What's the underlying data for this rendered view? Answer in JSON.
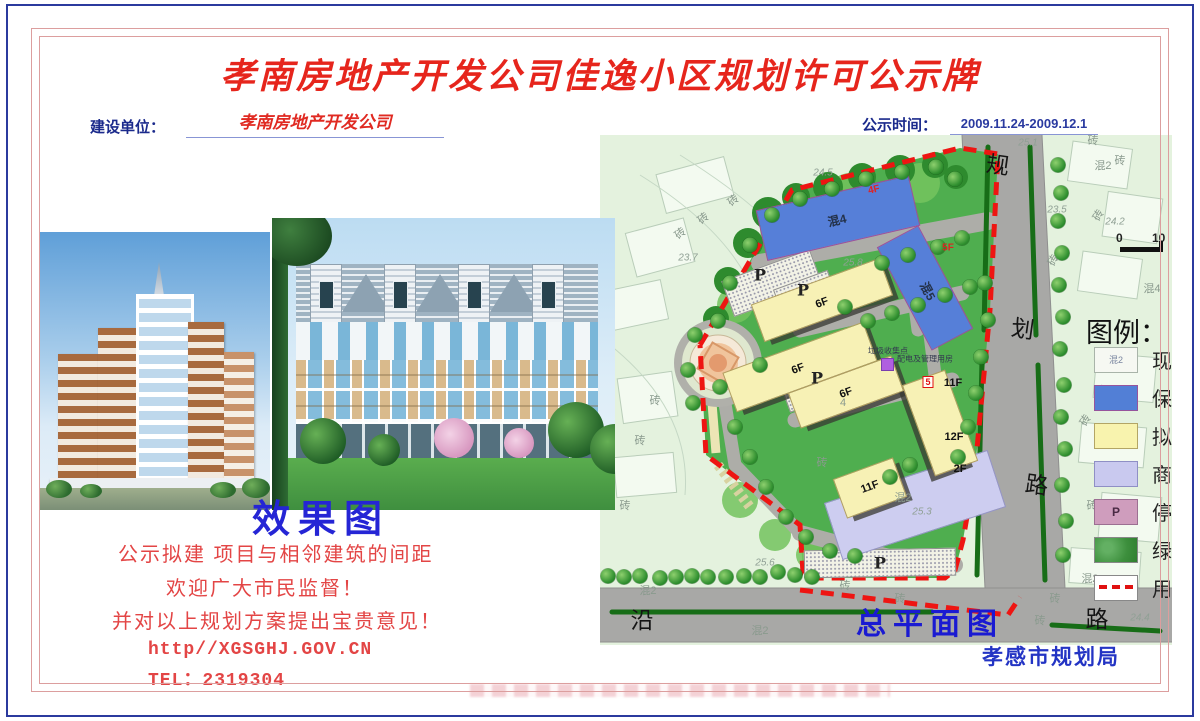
{
  "header": {
    "title": "孝南房地产开发公司佳逸小区规划许可公示牌",
    "builder_label": "建设单位：",
    "builder_value": "孝南房地产开发公司",
    "time_label": "公示时间：",
    "time_value": "2009.11.24-2009.12.1"
  },
  "left": {
    "caption": "效果图",
    "lines": [
      {
        "t": "公示拟建 项目与相邻建筑的间距",
        "x": 118,
        "y": 538,
        "mono": false
      },
      {
        "t": "欢迎广大市民监督！",
        "x": 166,
        "y": 572,
        "mono": false
      },
      {
        "t": "并对以上规划方案提出宝贵意见！",
        "x": 112,
        "y": 605,
        "mono": false
      },
      {
        "t": "http//XGSGHJ.GOV.CN",
        "x": 148,
        "y": 640,
        "mono": true
      },
      {
        "t": "TEL：2319304",
        "x": 148,
        "y": 665,
        "mono": true
      }
    ]
  },
  "map": {
    "plan_caption": "总平面图",
    "agency": "孝感市规划局",
    "legend": {
      "title": "图例：",
      "items": [
        {
          "sw": "existing",
          "sw_text": "混2",
          "label": "现"
        },
        {
          "sw": "blue",
          "sw_text": "",
          "label": "保"
        },
        {
          "sw": "yellow",
          "sw_text": "",
          "label": "拟"
        },
        {
          "sw": "lavender",
          "sw_text": "",
          "label": "商"
        },
        {
          "sw": "parking",
          "sw_text": "P",
          "label": "停"
        },
        {
          "sw": "green",
          "sw_text": "",
          "label": "绿"
        },
        {
          "sw": "redline",
          "sw_text": "",
          "label": "用"
        }
      ]
    },
    "scale": {
      "zero": "0",
      "ten": "10"
    },
    "buildings": [
      {
        "x": 315,
        "y": 370,
        "l": 170,
        "w": 58,
        "r": -18,
        "c": "#cdcdf0",
        "bc": "#9595c8",
        "sh": 0
      },
      {
        "x": 238,
        "y": 83,
        "l": 155,
        "w": 50,
        "r": -13,
        "c": "#567fd8",
        "bc": "#9c4f9c",
        "sh": 0
      },
      {
        "x": 325,
        "y": 153,
        "l": 115,
        "w": 45,
        "r": 62,
        "c": "#567fd8",
        "bc": "#9c4f9c",
        "sh": 0
      },
      {
        "x": 222,
        "y": 165,
        "l": 135,
        "w": 38,
        "r": -20,
        "c": "#f7f1b5",
        "bc": "#b3a060",
        "sh": 1
      },
      {
        "x": 200,
        "y": 232,
        "l": 148,
        "w": 40,
        "r": -20,
        "c": "#f7f1b5",
        "bc": "#b3a060",
        "sh": 1
      },
      {
        "x": 246,
        "y": 257,
        "l": 108,
        "w": 36,
        "r": -20,
        "c": "#f7f1b5",
        "bc": "#b3a060",
        "sh": 1
      },
      {
        "x": 340,
        "y": 288,
        "l": 95,
        "w": 44,
        "r": 70,
        "c": "#f7f1b5",
        "bc": "#b3a060",
        "sh": 1
      },
      {
        "x": 270,
        "y": 353,
        "l": 62,
        "w": 40,
        "r": -20,
        "c": "#f7f1b5",
        "bc": "#b3a060",
        "sh": 1
      }
    ],
    "parking": [
      {
        "x": 172,
        "y": 148,
        "l": 92,
        "w": 36,
        "r": -20
      },
      {
        "x": 205,
        "y": 158,
        "l": 56,
        "w": 26,
        "r": -20
      },
      {
        "x": 222,
        "y": 248,
        "l": 78,
        "w": 32,
        "r": -20
      },
      {
        "x": 280,
        "y": 428,
        "l": 150,
        "w": 26,
        "r": -1
      }
    ],
    "trees": [
      [
        458,
        30
      ],
      [
        461,
        58
      ],
      [
        458,
        86
      ],
      [
        462,
        118
      ],
      [
        459,
        150
      ],
      [
        463,
        182
      ],
      [
        460,
        214
      ],
      [
        464,
        250
      ],
      [
        461,
        282
      ],
      [
        465,
        314
      ],
      [
        462,
        350
      ],
      [
        466,
        386
      ],
      [
        463,
        420
      ],
      [
        8,
        441
      ],
      [
        24,
        442
      ],
      [
        40,
        441
      ],
      [
        60,
        443
      ],
      [
        76,
        442
      ],
      [
        92,
        441
      ],
      [
        108,
        442
      ],
      [
        126,
        442
      ],
      [
        144,
        441
      ],
      [
        160,
        442
      ],
      [
        178,
        437
      ],
      [
        195,
        440
      ],
      [
        212,
        442
      ],
      [
        172,
        80
      ],
      [
        200,
        64
      ],
      [
        232,
        54
      ],
      [
        266,
        44
      ],
      [
        302,
        37
      ],
      [
        336,
        32
      ],
      [
        355,
        44
      ],
      [
        150,
        110
      ],
      [
        130,
        148
      ],
      [
        118,
        186
      ],
      [
        282,
        128
      ],
      [
        308,
        120
      ],
      [
        338,
        112
      ],
      [
        362,
        103
      ],
      [
        245,
        172
      ],
      [
        268,
        186
      ],
      [
        292,
        178
      ],
      [
        318,
        170
      ],
      [
        345,
        160
      ],
      [
        370,
        152
      ],
      [
        385,
        148
      ],
      [
        388,
        185
      ],
      [
        381,
        222
      ],
      [
        376,
        258
      ],
      [
        368,
        292
      ],
      [
        358,
        322
      ],
      [
        120,
        252
      ],
      [
        135,
        292
      ],
      [
        150,
        322
      ],
      [
        166,
        352
      ],
      [
        186,
        382
      ],
      [
        206,
        402
      ],
      [
        230,
        416
      ],
      [
        255,
        421
      ],
      [
        95,
        200
      ],
      [
        88,
        235
      ],
      [
        93,
        268
      ],
      [
        160,
        230
      ],
      [
        310,
        330
      ],
      [
        290,
        342
      ]
    ],
    "labels": [
      {
        "t": "规",
        "x": 398,
        "y": 28,
        "k": "road",
        "r": 8
      },
      {
        "t": "划",
        "x": 423,
        "y": 192,
        "k": "road",
        "r": 8
      },
      {
        "t": "路",
        "x": 437,
        "y": 348,
        "k": "road",
        "r": 8
      },
      {
        "t": "沿",
        "x": 42,
        "y": 483,
        "k": "road",
        "r": 0
      },
      {
        "t": "路",
        "x": 497,
        "y": 482,
        "k": "road",
        "r": 0
      },
      {
        "t": "混4",
        "x": 237,
        "y": 85,
        "k": "b",
        "r": -13
      },
      {
        "t": "混5",
        "x": 328,
        "y": 156,
        "k": "b",
        "r": 62
      },
      {
        "t": "4F",
        "x": 274,
        "y": 55,
        "k": "fr",
        "r": -13
      },
      {
        "t": "5F",
        "x": 348,
        "y": 113,
        "k": "fr",
        "r": 0
      },
      {
        "t": "6F",
        "x": 222,
        "y": 168,
        "k": "f",
        "r": -20
      },
      {
        "t": "6F",
        "x": 198,
        "y": 234,
        "k": "f",
        "r": -20
      },
      {
        "t": "6F",
        "x": 246,
        "y": 258,
        "k": "f",
        "r": -20
      },
      {
        "t": "11F",
        "x": 353,
        "y": 248,
        "k": "f",
        "r": 0
      },
      {
        "t": "12F",
        "x": 354,
        "y": 302,
        "k": "f",
        "r": 0
      },
      {
        "t": "2F",
        "x": 360,
        "y": 334,
        "k": "f",
        "r": 0
      },
      {
        "t": "11F",
        "x": 270,
        "y": 352,
        "k": "f",
        "r": -20
      },
      {
        "t": "4",
        "x": 243,
        "y": 268,
        "k": "sm",
        "r": 0
      },
      {
        "t": "5",
        "x": 328,
        "y": 247,
        "k": "redbox",
        "r": 0
      },
      {
        "t": "P",
        "x": 160,
        "y": 140,
        "k": "P",
        "r": 0
      },
      {
        "t": "P",
        "x": 203,
        "y": 155,
        "k": "P",
        "r": 0
      },
      {
        "t": "P",
        "x": 217,
        "y": 243,
        "k": "P",
        "r": 0
      },
      {
        "t": "P",
        "x": 280,
        "y": 428,
        "k": "P",
        "r": 0
      },
      {
        "t": "垃圾收集点",
        "x": 288,
        "y": 216,
        "k": "tiny",
        "r": 0
      },
      {
        "t": "配电及管理用房",
        "x": 325,
        "y": 224,
        "k": "tiny",
        "r": 0
      },
      {
        "t": "混2",
        "x": 303,
        "y": 362,
        "k": "sm",
        "r": 0
      },
      {
        "t": "混2",
        "x": 503,
        "y": 30,
        "k": "sm",
        "r": 0
      },
      {
        "t": "混2",
        "x": 48,
        "y": 455,
        "k": "sm",
        "r": 0
      },
      {
        "t": "混2",
        "x": 160,
        "y": 495,
        "k": "sm",
        "r": 0
      },
      {
        "t": "混2",
        "x": 490,
        "y": 443,
        "k": "sm",
        "r": 0
      },
      {
        "t": "混2",
        "x": 530,
        "y": 457,
        "k": "sm",
        "r": 0
      },
      {
        "t": "混4",
        "x": 552,
        "y": 153,
        "k": "sm",
        "r": 0
      },
      {
        "t": "砖",
        "x": 133,
        "y": 65,
        "k": "sm",
        "r": -40
      },
      {
        "t": "砖",
        "x": 103,
        "y": 83,
        "k": "sm",
        "r": -40
      },
      {
        "t": "砖",
        "x": 80,
        "y": 98,
        "k": "sm",
        "r": -40
      },
      {
        "t": "砖",
        "x": 55,
        "y": 265,
        "k": "sm",
        "r": 0
      },
      {
        "t": "砖",
        "x": 40,
        "y": 305,
        "k": "sm",
        "r": 0
      },
      {
        "t": "砖",
        "x": 25,
        "y": 370,
        "k": "sm",
        "r": 0
      },
      {
        "t": "砖",
        "x": 493,
        "y": 5,
        "k": "sm",
        "r": 0
      },
      {
        "t": "砖",
        "x": 520,
        "y": 25,
        "k": "sm",
        "r": 0
      },
      {
        "t": "砖",
        "x": 498,
        "y": 80,
        "k": "sm",
        "r": -60
      },
      {
        "t": "砖",
        "x": 453,
        "y": 125,
        "k": "sm",
        "r": -60
      },
      {
        "t": "砖",
        "x": 500,
        "y": 255,
        "k": "sm",
        "r": 0
      },
      {
        "t": "砖",
        "x": 485,
        "y": 285,
        "k": "sm",
        "r": -60
      },
      {
        "t": "砖",
        "x": 492,
        "y": 370,
        "k": "sm",
        "r": 0
      },
      {
        "t": "砖",
        "x": 520,
        "y": 410,
        "k": "sm",
        "r": 0
      },
      {
        "t": "砖",
        "x": 245,
        "y": 450,
        "k": "sm",
        "r": 0
      },
      {
        "t": "砖",
        "x": 300,
        "y": 463,
        "k": "sm",
        "r": 0
      },
      {
        "t": "砖",
        "x": 440,
        "y": 485,
        "k": "sm",
        "r": 0
      },
      {
        "t": "砖",
        "x": 455,
        "y": 463,
        "k": "sm",
        "r": 0
      },
      {
        "t": "砖",
        "x": 222,
        "y": 327,
        "k": "sm",
        "r": 0
      },
      {
        "t": "24.5",
        "x": 223,
        "y": 38,
        "k": "elev",
        "r": 0
      },
      {
        "t": "23.7",
        "x": 88,
        "y": 123,
        "k": "elev",
        "r": 0
      },
      {
        "t": "25.1",
        "x": 428,
        "y": 8,
        "k": "elev",
        "r": 0
      },
      {
        "t": "23.5",
        "x": 457,
        "y": 75,
        "k": "elev",
        "r": 0
      },
      {
        "t": "24.2",
        "x": 515,
        "y": 87,
        "k": "elev",
        "r": 0
      },
      {
        "t": "25.8",
        "x": 253,
        "y": 128,
        "k": "elev",
        "r": 0
      },
      {
        "t": "25.3",
        "x": 322,
        "y": 377,
        "k": "elev",
        "r": 0
      },
      {
        "t": "25.6",
        "x": 165,
        "y": 428,
        "k": "elev",
        "r": 0
      },
      {
        "t": "24.4",
        "x": 540,
        "y": 483,
        "k": "elev",
        "r": 0
      }
    ]
  },
  "colors": {
    "title_red": "#e6251c",
    "label_navy": "#1b2a8c",
    "value_red": "#e02a22",
    "caption_blue": "#2525d5",
    "notice_red": "#e34545",
    "plan_caption_blue": "#1a1ad2",
    "agency_blue": "#2334c4",
    "boundary_red": "#ee1512",
    "site_green": "#4fae4f",
    "road_gray": "#a8a8a6",
    "building_blue": "#567fd8",
    "building_yellow": "#f7f1b5",
    "podium_lavender": "#cdcdf0",
    "map_bg": "#e4f2de"
  }
}
